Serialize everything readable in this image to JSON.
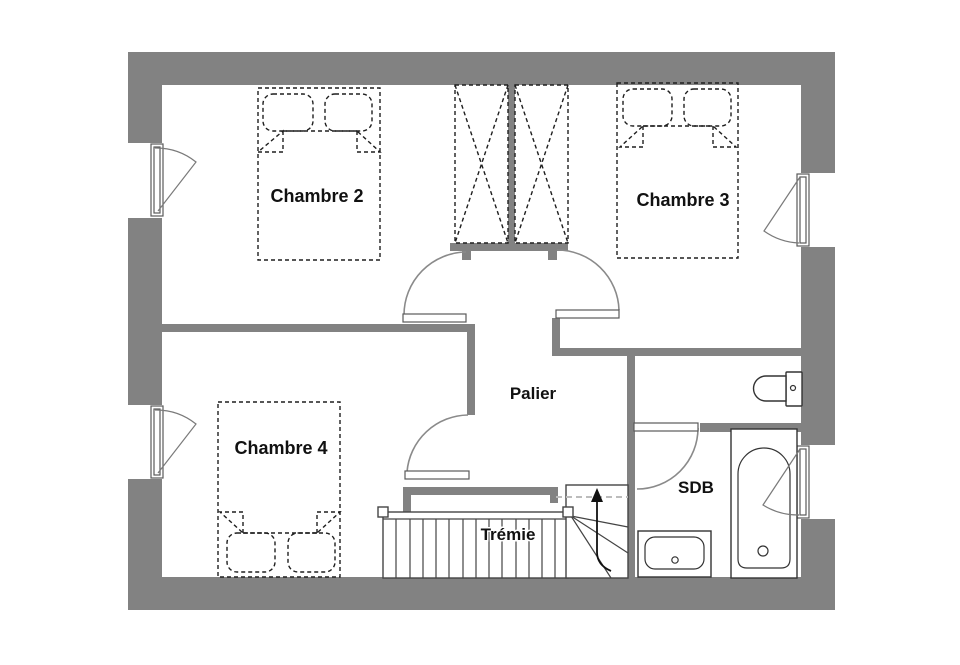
{
  "floor_plan": {
    "title": "Floor plan - upper storey",
    "colors": {
      "wall": "#828282",
      "furniture_outline": "#1f1f1f",
      "fixture_outline": "#333333",
      "door_swing": "#8a8a8a",
      "tremie_dashed_line": "#bcbcbc",
      "label_text": "#111111",
      "background": "#ffffff"
    },
    "rooms": [
      {
        "id": "chambre-2",
        "label": "Chambre 2"
      },
      {
        "id": "chambre-3",
        "label": "Chambre 3"
      },
      {
        "id": "chambre-4",
        "label": "Chambre 4"
      },
      {
        "id": "palier",
        "label": "Palier"
      },
      {
        "id": "sdb",
        "label": "SDB"
      }
    ],
    "stairwell": {
      "label": "Trémie",
      "direction_arrow": "up"
    },
    "fixtures": [
      {
        "name": "double-bed",
        "room": "chambre-2"
      },
      {
        "name": "double-bed",
        "room": "chambre-3"
      },
      {
        "name": "double-bed",
        "room": "chambre-4"
      },
      {
        "name": "wardrobe-2-doors",
        "room": "palier"
      },
      {
        "name": "staircase-with-winders",
        "room": "tremie"
      },
      {
        "name": "toilet",
        "room": "sdb"
      },
      {
        "name": "bathtub",
        "room": "sdb"
      },
      {
        "name": "washbasin",
        "room": "sdb"
      }
    ],
    "openings": {
      "doors": 4,
      "windows": 4
    }
  }
}
